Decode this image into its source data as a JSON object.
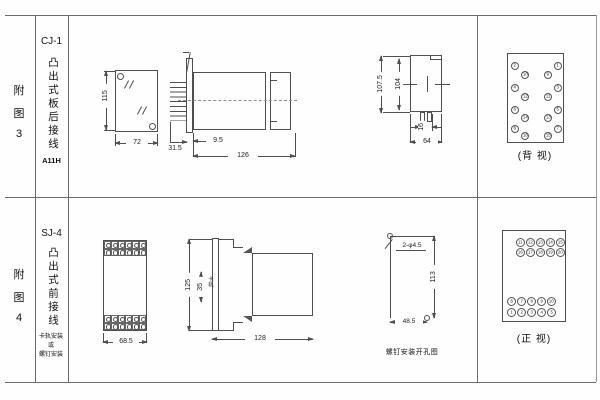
{
  "rows": [
    {
      "figure_chars": [
        "附",
        "图",
        "3"
      ],
      "model": "CJ-1",
      "mount_type": "凸出式板后接线",
      "code": "A11H",
      "panel_view": {
        "height_dim": "115",
        "width_dim": "72"
      },
      "side_view": {
        "depth_front": "9.5",
        "depth_pins": "31.5",
        "depth_total": "126"
      },
      "rear_view": {
        "height_outer": "107.5",
        "height_inner": "104",
        "slot_width": "16",
        "width": "64"
      },
      "terminal_view": {
        "caption": "(背 视)",
        "left_outer": [
          "2",
          "4",
          "6",
          "8"
        ],
        "left_inner": [
          "10",
          "12",
          "14",
          "16"
        ],
        "right_inner": [
          "9",
          "11",
          "13",
          "15"
        ],
        "right_outer": [
          "1",
          "3",
          "5",
          "7"
        ]
      }
    },
    {
      "figure_chars": [
        "附",
        "图",
        "4"
      ],
      "model": "SJ-4",
      "mount_type": "凸出式前接线",
      "mount_note": [
        "卡轨安装",
        "或",
        "螺钉安装"
      ],
      "front_view": {
        "width_dim": "68.5"
      },
      "side_view": {
        "height_dim": "125",
        "rail_width": "35",
        "rail_label": "卡轨",
        "depth_dim": "128"
      },
      "drill_view": {
        "holes_label": "2-φ4.5",
        "height_dim": "113",
        "width_dim": "48.5",
        "caption": "螺钉安装开孔图"
      },
      "terminal_view": {
        "caption": "(正 视)",
        "top_rows": [
          [
            "11",
            "12",
            "13",
            "14",
            "15"
          ],
          [
            "16",
            "17",
            "18",
            "19",
            "20"
          ]
        ],
        "bottom_rows": [
          [
            "6",
            "7",
            "8",
            "9",
            "10"
          ],
          [
            "1",
            "2",
            "3",
            "4",
            "5"
          ]
        ]
      }
    }
  ]
}
